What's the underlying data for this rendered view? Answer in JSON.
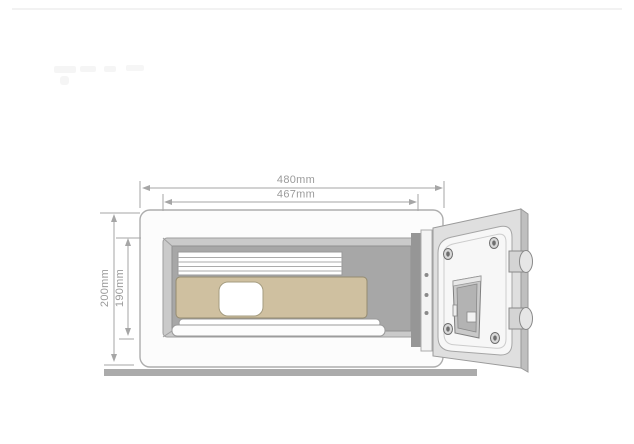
{
  "diagram": {
    "type": "product-dimension-diagram",
    "subject": "open-electronic-safe-with-laptop"
  },
  "dimensions": {
    "outer_width": "480mm",
    "inner_width": "467mm",
    "outer_height": "200mm",
    "inner_height": "190mm"
  },
  "colors": {
    "laptop": "#cfc0a0",
    "interior": "#a7a7a7",
    "bevel": "#cacaca",
    "floor": "#ababab",
    "dimension_line": "#a6a6a6",
    "body_fill": "#fcfcfc",
    "door_frame": "#dfdfdf"
  }
}
